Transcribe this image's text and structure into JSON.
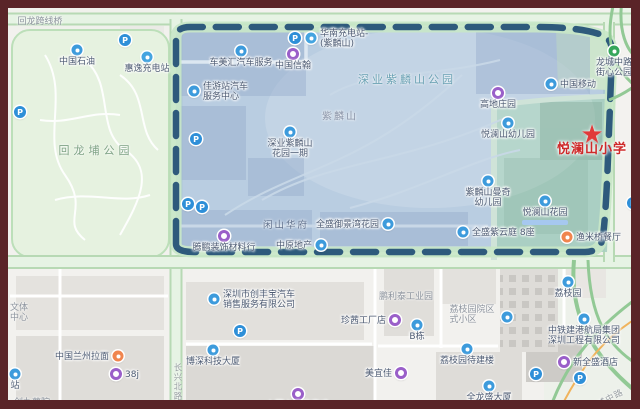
{
  "frame": {
    "border_color": "#5a2428"
  },
  "colors": {
    "boundary_dash": "#2e5a7c",
    "zone_fill": "#aac4dd",
    "teal_zone_fill": "#a9cfc0",
    "park_fill": "#e6f2e0",
    "road_green": "#b7d9b4",
    "school_red": "#ce2a2a",
    "poi_blue": "#3d9bdc",
    "poi_purple": "#9a5fc9",
    "poi_orange": "#f0854e",
    "poi_green": "#35a65b"
  },
  "icons": {
    "parking": "P",
    "star": "★"
  },
  "map": {
    "school": {
      "name": "悦澜山小学"
    },
    "pois": [
      {
        "name": "sinopec",
        "icon": "blue",
        "x": 69,
        "y": 42,
        "label": [
          "中国石油"
        ],
        "lp": "below"
      },
      {
        "name": "huiyi-charging-station",
        "icon": "charging",
        "x": 139,
        "y": 49,
        "label": [
          "惠逸充电站"
        ],
        "lp": "below"
      },
      {
        "name": "parking-1",
        "icon": "parking",
        "x": 117,
        "y": 32
      },
      {
        "name": "parking-2",
        "icon": "parking",
        "x": 12,
        "y": 104
      },
      {
        "name": "chemeihui-auto-service",
        "icon": "blue",
        "x": 233,
        "y": 43,
        "label": [
          "车美汇汽车服务"
        ],
        "lp": "below"
      },
      {
        "name": "parking-3",
        "icon": "parking",
        "x": 287,
        "y": 30
      },
      {
        "name": "huanan-charging-station",
        "icon": "charging",
        "x": 303,
        "y": 30,
        "label": [
          "华南充电站-",
          "(紫麟山)"
        ],
        "lp": "right"
      },
      {
        "name": "zhongguo-xinhan",
        "icon": "purple",
        "x": 285,
        "y": 46,
        "label": [
          "中国信翰"
        ],
        "lp": "below"
      },
      {
        "name": "jiayouzhan-auto-center",
        "icon": "blue",
        "x": 186,
        "y": 83,
        "label": [
          "佳游站汽车",
          "服务中心"
        ],
        "lp": "right"
      },
      {
        "name": "parking-4",
        "icon": "parking",
        "x": 188,
        "y": 131
      },
      {
        "name": "shenye-zilinshan-garden-phase1",
        "icon": "blue",
        "x": 282,
        "y": 124,
        "label": [
          "深业紫麟山",
          "花园一期"
        ],
        "lp": "below"
      },
      {
        "name": "parking-5",
        "icon": "parking",
        "x": 180,
        "y": 196
      },
      {
        "name": "parking-6",
        "icon": "parking",
        "x": 194,
        "y": 199
      },
      {
        "name": "tengpeng-decoration-materials",
        "icon": "purple",
        "x": 216,
        "y": 228,
        "label": [
          "腾鹏装饰材料行"
        ],
        "lp": "below"
      },
      {
        "name": "zhongyuan-realty",
        "icon": "blue",
        "x": 313,
        "y": 237,
        "label": [
          "中原地产"
        ],
        "lp": "left"
      },
      {
        "name": "quansheng-yujingwan-garden",
        "icon": "blue",
        "x": 380,
        "y": 216,
        "label": [
          "全盛御景湾花园"
        ],
        "lp": "left"
      },
      {
        "name": "zilinshan-manqi-kindergarten",
        "icon": "blue",
        "x": 480,
        "y": 173,
        "label": [
          "紫麟山曼奇",
          "幼儿园"
        ],
        "lp": "below"
      },
      {
        "name": "yuelanshan-garden",
        "icon": "blue",
        "x": 537,
        "y": 193,
        "label": [
          "悦澜山花园"
        ],
        "lp": "below",
        "highlight": true
      },
      {
        "name": "quansheng-ziyunting-8",
        "icon": "blue",
        "x": 455,
        "y": 224,
        "label": [
          "全盛紫云庭 8座"
        ],
        "lp": "right"
      },
      {
        "name": "yuelanshan-kindergarten",
        "icon": "blue",
        "x": 500,
        "y": 115,
        "label": [
          "悦澜山幼儿园"
        ],
        "lp": "below"
      },
      {
        "name": "gaodi-manor",
        "icon": "purple",
        "x": 490,
        "y": 85,
        "label": [
          "高地庄园"
        ],
        "lp": "below"
      },
      {
        "name": "china-mobile",
        "icon": "blue",
        "x": 543,
        "y": 76,
        "label": [
          "中国移动"
        ],
        "lp": "right"
      },
      {
        "name": "longcheng-street-park",
        "icon": "green",
        "x": 606,
        "y": 43,
        "label": [
          "龙城中路",
          "街心公园"
        ],
        "lp": "below"
      },
      {
        "name": "yumiqiao-restaurant",
        "icon": "orange",
        "x": 559,
        "y": 229,
        "label": [
          "渔米桥餐厅"
        ],
        "lp": "right"
      },
      {
        "name": "parking-7",
        "icon": "parking",
        "x": 625,
        "y": 195
      },
      {
        "name": "yuelanshan-primary-school",
        "icon": "star",
        "x": 584,
        "y": 127,
        "label": [
          "悦澜山小学"
        ],
        "lp": "below",
        "cls": "school-label"
      },
      {
        "name": "chuangfengbao-auto-sales",
        "icon": "blue",
        "x": 206,
        "y": 291,
        "label": [
          "深圳市创丰宝汽车",
          "销售服务有限公司"
        ],
        "lp": "right"
      },
      {
        "name": "zhenqian-factory-store",
        "icon": "purple",
        "x": 387,
        "y": 312,
        "label": [
          "珍茜工厂店"
        ],
        "lp": "left"
      },
      {
        "name": "building-b",
        "icon": "blue",
        "x": 409,
        "y": 317,
        "label": [
          "B栋"
        ],
        "lp": "below"
      },
      {
        "name": "boshen-tech-tower",
        "icon": "blue",
        "x": 205,
        "y": 342,
        "label": [
          "博深科技大厦"
        ],
        "lp": "below"
      },
      {
        "name": "meiyijia",
        "icon": "purple",
        "x": 393,
        "y": 365,
        "label": [
          "美宜佳"
        ],
        "lp": "left"
      },
      {
        "name": "shangyuan-shangpin",
        "icon": "purple",
        "x": 290,
        "y": 386,
        "label": [
          "上园上品砖窑鸡"
        ],
        "lp": "below"
      },
      {
        "name": "lanzhou-noodles",
        "icon": "orange",
        "x": 110,
        "y": 348,
        "label": [
          "中国兰州拉面"
        ],
        "lp": "left"
      },
      {
        "name": "shop-38j",
        "icon": "purple",
        "x": 108,
        "y": 366,
        "label": [
          "38j"
        ],
        "lp": "right"
      },
      {
        "name": "station",
        "icon": "blue",
        "x": 7,
        "y": 366,
        "label": [
          "站"
        ],
        "lp": "below"
      },
      {
        "name": "lizhiyuan",
        "icon": "blue",
        "x": 560,
        "y": 274,
        "label": [
          "荔枝园"
        ],
        "lp": "below"
      },
      {
        "name": "lizhiyuan-compound-marker",
        "icon": "blue",
        "x": 499,
        "y": 309
      },
      {
        "name": "zhongtiejian-port-group",
        "icon": "blue",
        "x": 576,
        "y": 311,
        "label": [
          "中铁建港航局集团",
          "深圳工程有限公司"
        ],
        "lp": "below"
      },
      {
        "name": "xinquansheng-hotel",
        "icon": "purple",
        "x": 556,
        "y": 354,
        "label": [
          "新全盛酒店"
        ],
        "lp": "right"
      },
      {
        "name": "lizhiyuan-pending-building",
        "icon": "blue",
        "x": 459,
        "y": 341,
        "label": [
          "荔枝园待建楼"
        ],
        "lp": "below"
      },
      {
        "name": "quanlongsheng-tower",
        "icon": "blue",
        "x": 481,
        "y": 378,
        "label": [
          "全龙盛大厦"
        ],
        "lp": "below"
      },
      {
        "name": "parking-8",
        "icon": "parking",
        "x": 528,
        "y": 366
      },
      {
        "name": "parking-9",
        "icon": "parking",
        "x": 572,
        "y": 370
      },
      {
        "name": "parking-10",
        "icon": "parking",
        "x": 232,
        "y": 323
      }
    ],
    "text_labels": [
      {
        "name": "huilong-flyover",
        "lines": [
          "回龙跨线桥"
        ],
        "x": 32,
        "y": 14,
        "cls": "cls-gray"
      },
      {
        "name": "huilongpu-park",
        "lines": [
          "回龙埔公园"
        ],
        "x": 88,
        "y": 142,
        "cls": "cls-park"
      },
      {
        "name": "shenye-zilinshan-park",
        "lines": [
          "深业紫麟山公园"
        ],
        "x": 399,
        "y": 71,
        "cls": "cls-tealtext"
      },
      {
        "name": "zilinshan-hill",
        "lines": [
          "紫麟山"
        ],
        "x": 332,
        "y": 107,
        "cls": "cls-hill"
      },
      {
        "name": "xianshan-huafu",
        "lines": [
          "闲山华府"
        ],
        "x": 278,
        "y": 216,
        "cls": "cls-area"
      },
      {
        "name": "penglitai-industrial-park",
        "lines": [
          "鹏利泰工业园"
        ],
        "x": 398,
        "y": 289,
        "cls": "cls-gray"
      },
      {
        "name": "lizhiyuan-compound",
        "lines": [
          "荔枝园院区",
          "式小区"
        ],
        "x": 464,
        "y": 307,
        "cls": "cls-gray"
      },
      {
        "name": "wenti-center",
        "lines": [
          "文体",
          "中心"
        ],
        "x": 2,
        "y": 305,
        "cls": "cls-gray",
        "align": "left"
      },
      {
        "name": "chuangjiu-shuyuan",
        "lines": [
          "创九薯院"
        ],
        "x": 24,
        "y": 395,
        "cls": "cls-gray"
      },
      {
        "name": "changxing-north-road",
        "lines": [
          "长兴北路"
        ],
        "x": 169,
        "y": 374,
        "cls": "cls-road",
        "vertical": true
      },
      {
        "name": "longcheng-middle-road",
        "lines": [
          "龙城中路"
        ],
        "x": 598,
        "y": 392,
        "cls": "cls-road",
        "rotate": -28
      }
    ]
  }
}
